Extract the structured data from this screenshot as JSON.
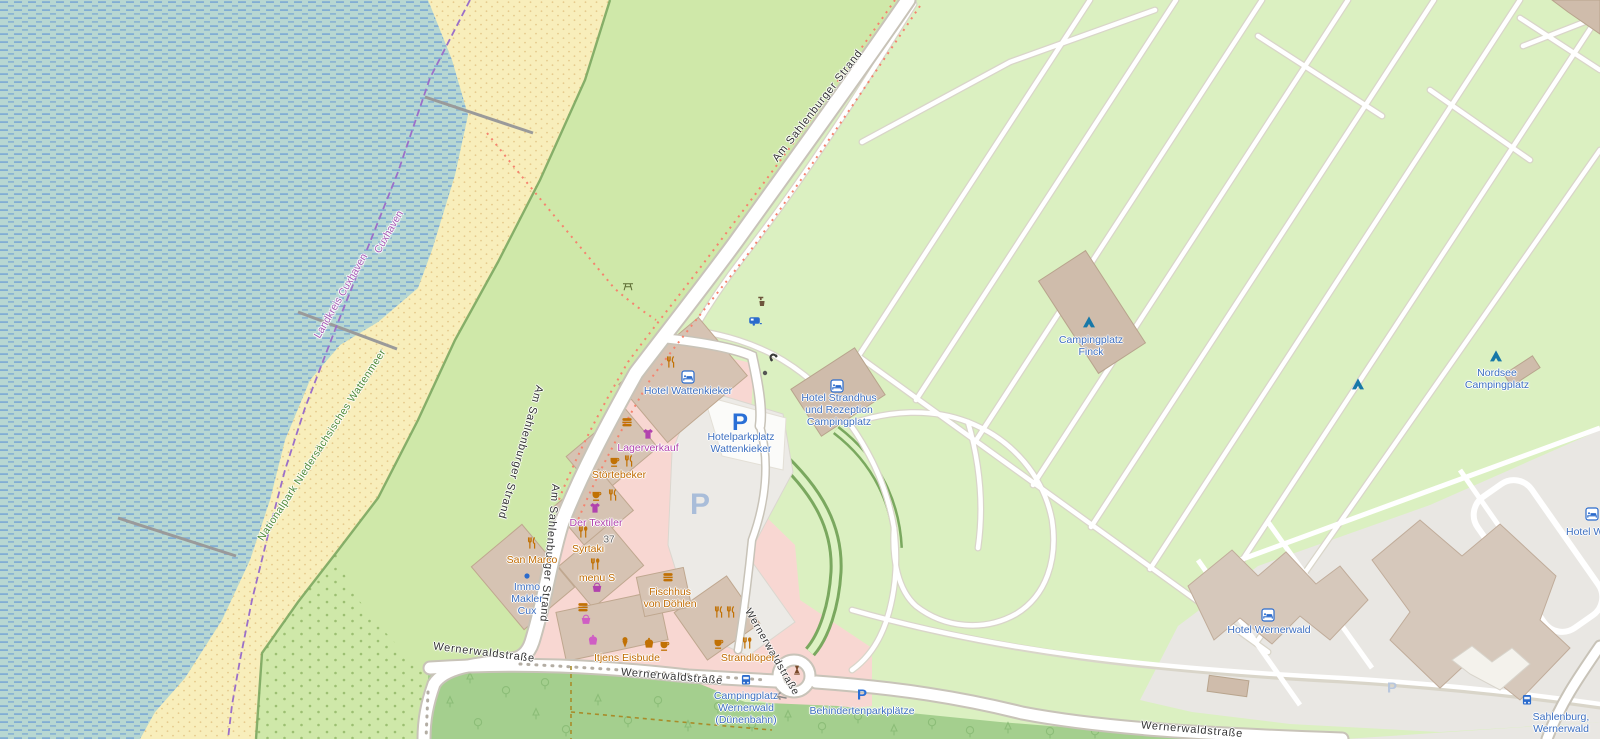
{
  "streets": {
    "am_sahlenburger_strand": "Am Sahlenburger Strand",
    "wernerwaldstrasse": "Wernerwaldstraße"
  },
  "boundary": {
    "landkreis_cuxhaven": "Landkreis Cuxhaven",
    "cuxhaven": "Cuxhaven"
  },
  "areas": {
    "national_park": "Nationalpark Niedersächsisches Wattenmeer"
  },
  "pois": {
    "hotel_wattenkieker": "Hotel Wattenkieker",
    "hotelparkplatz_wattenkieker": "Hotelparkplatz\nWattenkieker",
    "lagerverkauf": "Lagerverkauf",
    "stoertebeker": "Störtebeker",
    "der_textiler": "Der Textiler",
    "house_number_37": "37",
    "syrtaki": "Syrtaki",
    "san_marco": "San Marco",
    "immo_makler_cux": "Immo\nMakler\nCux",
    "menu_s": "menu S",
    "fischhus_von_doehlen": "Fischhus\nvon Döhlen",
    "itjens_eisbude": "Itjens Eisbude",
    "strandloeper": "Strandlöper",
    "hotel_strandhus": "Hotel Strandhus\nund Rezeption\nCampingplatz",
    "campingplatz_finck": "Campingplatz\nFinck",
    "nordsee_campingplatz": "Nordsee\nCampingplatz",
    "hotel_wernerwald": "Hotel Wernerwald",
    "hotel_wernerwald_cut": "Hotel We",
    "campingplatz_wernerwald": "Campingplatz\nWernerwald\n(Dünenbahn)",
    "behindertenparkplaetze": "Behindertenparkplätze",
    "sahlenburg_wernerwald": "Sahlenburg,\nWernerwald"
  },
  "parking": {
    "letter": "P"
  },
  "icons": {
    "restaurant": "fork-and-knife",
    "fast_food": "burger",
    "cafe": "cup",
    "ice_cream": "ice-cream-cone",
    "bakery": "cake",
    "clothes_shop": "t-shirt",
    "shop": "basket",
    "hotel": "bed",
    "campsite": "tent",
    "bus_stop": "bus",
    "caravan_site": "caravan",
    "telephone": "phone-handset",
    "picnic_site": "picnic-table",
    "water_point": "tap-and-bucket",
    "monument": "obelisk",
    "parking": "letter-P"
  },
  "colors": {
    "water_base": "#b7d7d2",
    "water_dash": "#6f9fd4",
    "sand": "#f8eebb",
    "grass": "#cfe8a9",
    "campsite": "#dbf0c1",
    "forest": "#a4cf8e",
    "retail_area": "#f8d7d2",
    "building": "#d6c3b3",
    "road_fill": "#ffffff",
    "road_casing": "#c8c3b8",
    "footpath": "#f5836e",
    "boundary_purple": "#9b6fc9",
    "label_blue": "#3d6fc0",
    "label_orange": "#c06a00",
    "label_shop": "#b143ae",
    "park_green": "#4e8a37",
    "parking_blue": "#2a6fd6"
  }
}
